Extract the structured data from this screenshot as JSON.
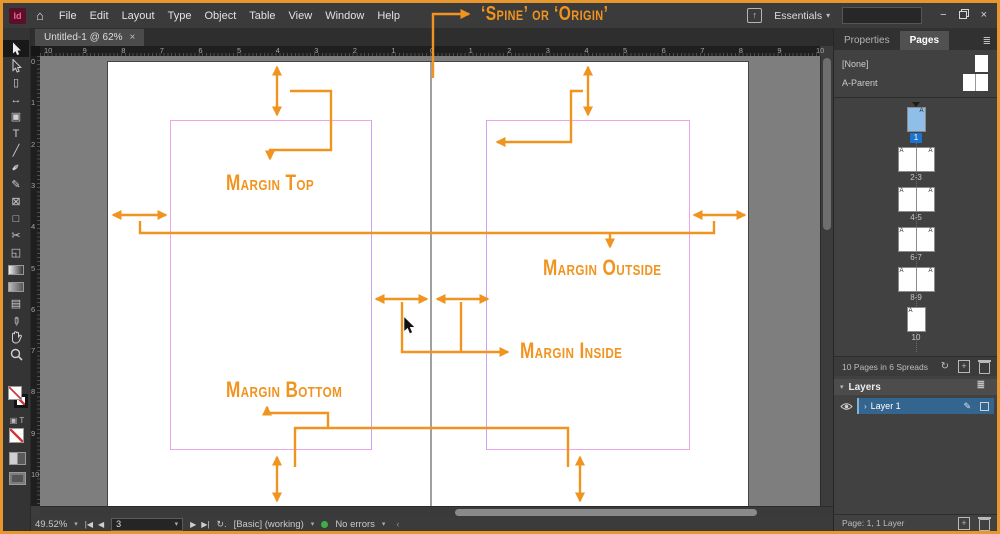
{
  "colors": {
    "accent_orange": "#F0941F",
    "frame_border": "#E8962E",
    "margin_guide_pink": "#EFA3E9",
    "column_guide_violet": "#C6A4EE",
    "selection_blue": "#1D74CF",
    "no_error_green": "#3FAE49"
  },
  "menu_bar": {
    "logo_text": "Id",
    "items": [
      "File",
      "Edit",
      "Layout",
      "Type",
      "Object",
      "Table",
      "View",
      "Window",
      "Help"
    ],
    "workspace_label": "Essentials",
    "search_placeholder": ""
  },
  "window_controls": {
    "minimize": "−",
    "close": "×"
  },
  "document": {
    "tab_title": "Untitled-1 @ 62%",
    "tab_close": "×"
  },
  "rulers": {
    "horizontal": [
      "10",
      "9",
      "8",
      "7",
      "6",
      "5",
      "4",
      "3",
      "2",
      "1",
      "0",
      "1",
      "2",
      "3",
      "4",
      "5",
      "6",
      "7",
      "8",
      "9",
      "10"
    ],
    "vertical": [
      "0",
      "1",
      "2",
      "3",
      "4",
      "5",
      "6",
      "7",
      "8",
      "9",
      "10"
    ]
  },
  "toolbar": {
    "tools": [
      {
        "name": "selection-tool",
        "svg": "pointer-filled",
        "active": true
      },
      {
        "name": "direct-selection-tool",
        "svg": "pointer-outline"
      },
      {
        "name": "page-tool",
        "glyph": "▯"
      },
      {
        "name": "gap-tool",
        "glyph": "↔"
      },
      {
        "name": "content-collector-tool",
        "glyph": "▣"
      },
      {
        "name": "type-tool",
        "glyph": "T"
      },
      {
        "name": "line-tool",
        "glyph": "╱"
      },
      {
        "name": "pen-tool",
        "glyph": "✒",
        "rotate": -45
      },
      {
        "name": "pencil-tool",
        "glyph": "✎"
      },
      {
        "name": "rectangle-frame-tool",
        "glyph": "⊠"
      },
      {
        "name": "rectangle-tool",
        "glyph": "□"
      },
      {
        "name": "scissors-tool",
        "glyph": "✂"
      },
      {
        "name": "free-transform-tool",
        "glyph": "◱"
      },
      {
        "name": "gradient-swatch-tool",
        "svg": "gradient"
      },
      {
        "name": "gradient-feather-tool",
        "svg": "gradient-feather"
      },
      {
        "name": "note-tool",
        "glyph": "▤"
      },
      {
        "name": "eyedropper-tool",
        "glyph": "✐",
        "rotate": 135
      },
      {
        "name": "hand-tool",
        "svg": "hand"
      },
      {
        "name": "zoom-tool",
        "svg": "zoom"
      }
    ]
  },
  "annotations": {
    "spine_origin": "‘Spine’ or ‘Origin’",
    "margin_top": "Margin Top",
    "margin_outside": "Margin Outside",
    "margin_inside": "Margin Inside",
    "margin_bottom": "Margin Bottom"
  },
  "pages_panel": {
    "tab_properties": "Properties",
    "tab_pages": "Pages",
    "parents": [
      {
        "label": "[None]",
        "icon": "single"
      },
      {
        "label": "A-Parent",
        "icon": "spread"
      }
    ],
    "parent_prefix": "A",
    "pages": [
      {
        "label": "1",
        "type": "single",
        "selected": true,
        "corner": "right"
      },
      {
        "label": "2-3",
        "type": "spread"
      },
      {
        "label": "4-5",
        "type": "spread"
      },
      {
        "label": "6-7",
        "type": "spread"
      },
      {
        "label": "8-9",
        "type": "spread"
      },
      {
        "label": "10",
        "type": "single",
        "corner": "left"
      }
    ],
    "footer_text": "10 Pages in 6 Spreads"
  },
  "layers_panel": {
    "title": "Layers",
    "layers": [
      {
        "name": "Layer 1",
        "selected": true
      }
    ]
  },
  "status_bar": {
    "zoom_level": "49.52%",
    "page_field_value": "3",
    "preflight_profile": "[Basic] (working)",
    "preflight_status": "No errors",
    "page_info": "Page: 1, 1 Layer"
  }
}
